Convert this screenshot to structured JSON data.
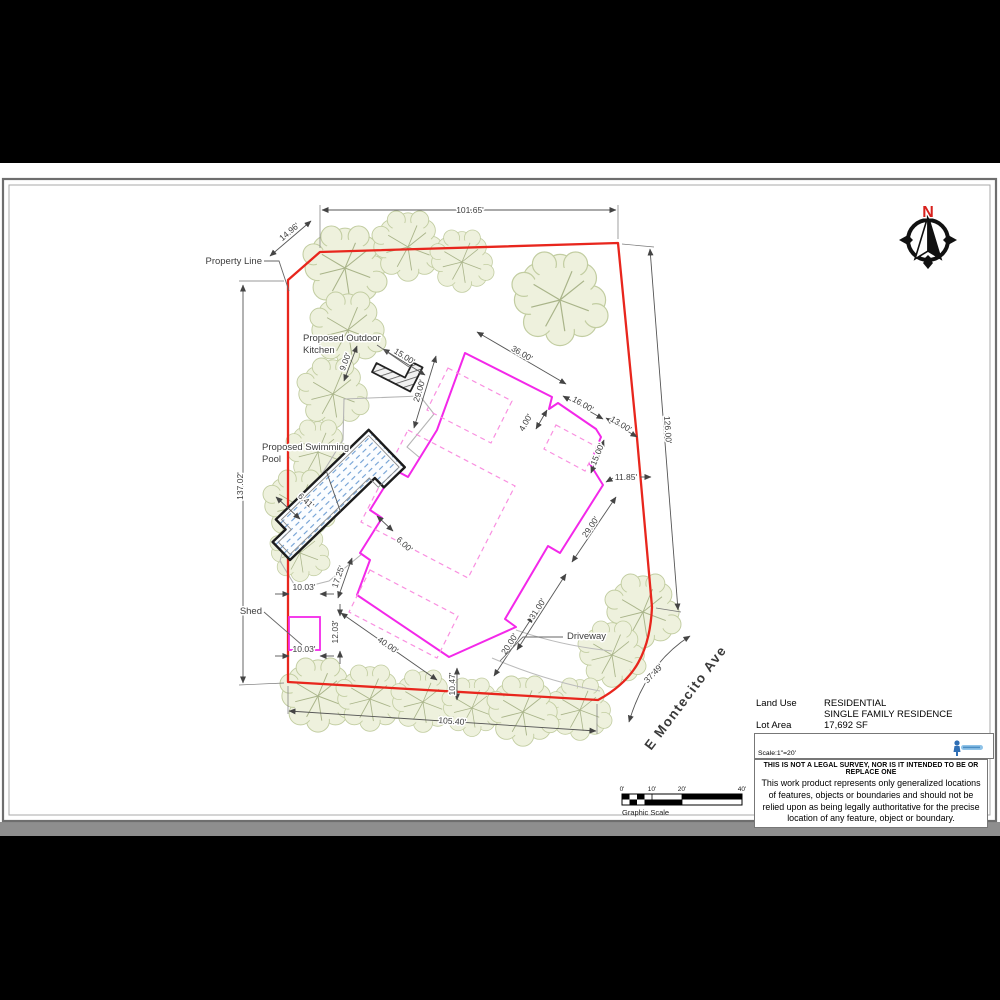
{
  "plan": {
    "labels": {
      "property_line": "Property Line",
      "kitchen_l1": "Proposed Outdoor",
      "kitchen_l2": "Kitchen",
      "pool_l1": "Proposed Swimming",
      "pool_l2": "Pool",
      "shed": "Shed",
      "driveway": "Driveway",
      "street": "E Montecito Ave",
      "north": "N"
    },
    "dimensions": {
      "top": "101.65'",
      "bevel": "14.96'",
      "right": "126.00'",
      "left": "137.02'",
      "bottom": "105.40'",
      "street_frontage": "37.49'",
      "house_top": "36.00'",
      "garage_top": "16.00'",
      "gap_ne": "13.00'",
      "step": "4.00'",
      "garage_side": "15.00'",
      "gap_east": "11.85'",
      "house_se": "29.00'",
      "house_s": "31.00'",
      "driveway_width": "20.00'",
      "gap_south": "10.47'",
      "wing_bottom": "40.00'",
      "wing_side": "17.25'",
      "pool_gap_sw": "6.41'",
      "pool_house_gap": "6.00'",
      "kitchen_top": "15.00'",
      "kitchen_side": "9.00'",
      "kitchen_house_gap": "29.00'",
      "shed_width_top": "10.03'",
      "shed_side": "12.03'",
      "shed_width_bottom": "10.03'"
    }
  },
  "legend": {
    "land_use_label": "Land Use",
    "land_use_value_1": "RESIDENTIAL",
    "land_use_value_2": "SINGLE FAMILY RESIDENCE",
    "lot_area_label": "Lot Area",
    "lot_area_value": "17,692 SF",
    "scale_text": "Scale:1\"=20'",
    "disclaimer_title": "THIS IS NOT A LEGAL SURVEY, NOR IS IT INTENDED TO BE OR REPLACE ONE",
    "disclaimer_body": "This work product represents only generalized locations of features, objects or boundaries and should not be relied upon as being legally authoritative for the precise location of any feature, object or boundary."
  },
  "scale_bar": {
    "ticks": [
      "0'",
      "10'",
      "20'",
      "40'"
    ],
    "label": "Graphic Scale"
  }
}
